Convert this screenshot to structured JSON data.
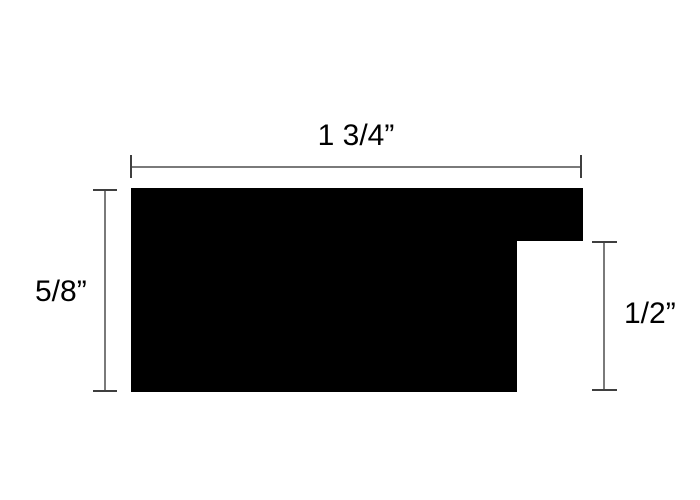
{
  "diagram": {
    "colors": {
      "background": "#ffffff",
      "shape": "#000000",
      "dimension_line": "#7a7a7a",
      "dimension_tick": "#3f3f3f",
      "text": "#000000"
    },
    "dimensions": {
      "width": {
        "label": "1 3/4”",
        "position": "top"
      },
      "height": {
        "label": "5/8”",
        "position": "left"
      },
      "notch": {
        "label": "1/2”",
        "position": "right"
      }
    }
  }
}
